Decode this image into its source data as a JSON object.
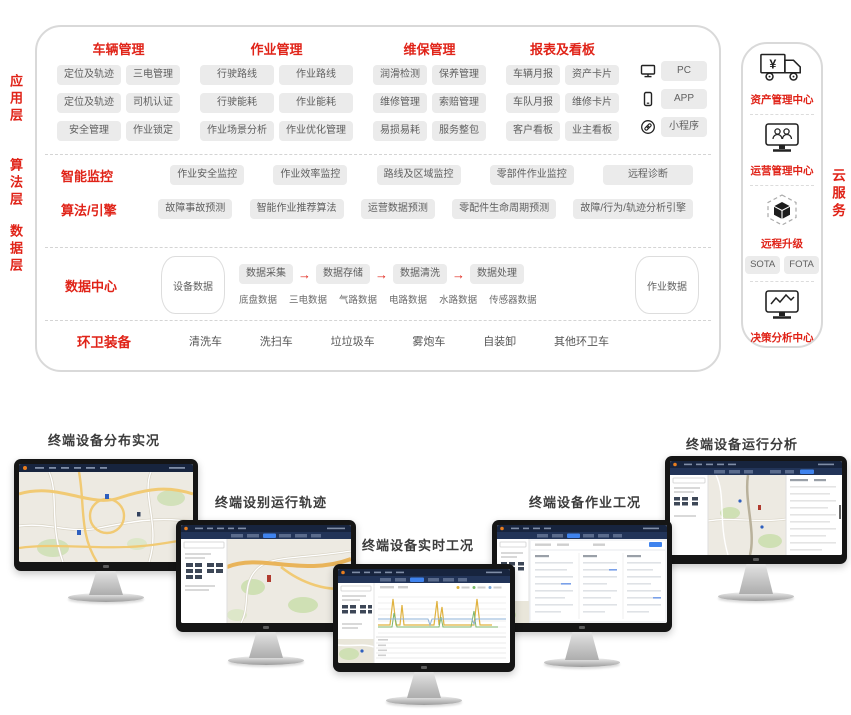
{
  "colors": {
    "accent_red": "#e02318",
    "pill_bg": "#ebebeb",
    "pill_text": "#5f5f5f",
    "screen_topbar": "#17243e",
    "screen_navbar": "#223458",
    "tab_blue": "#3f83ee"
  },
  "architecture": {
    "layer_labels": [
      "应用层",
      "算法层",
      "数据层"
    ],
    "app": {
      "groups": [
        {
          "title": "车辆管理",
          "pills": [
            "定位及轨迹",
            "三电管理",
            "定位及轨迹",
            "司机认证",
            "安全管理",
            "作业锁定"
          ]
        },
        {
          "title": "作业管理",
          "pills": [
            "行驶路线",
            "作业路线",
            "行驶能耗",
            "作业能耗",
            "作业场景分析",
            "作业优化管理"
          ]
        },
        {
          "title": "维保管理",
          "pills": [
            "润滑检测",
            "保养管理",
            "维修管理",
            "索赔管理",
            "易损易耗",
            "服务整包"
          ]
        },
        {
          "title": "报表及看板",
          "pills": [
            "车辆月报",
            "资产卡片",
            "车队月报",
            "维修卡片",
            "客户看板",
            "业主看板"
          ]
        }
      ],
      "channels": [
        {
          "icon": "pc-icon",
          "label": "PC"
        },
        {
          "icon": "phone-icon",
          "label": "APP"
        },
        {
          "icon": "miniprogram-icon",
          "label": "小程序"
        }
      ]
    },
    "algo": {
      "rows": [
        {
          "title": "智能监控",
          "pills": [
            "作业安全监控",
            "作业效率监控",
            "路线及区域监控",
            "零部件作业监控",
            "远程诊断"
          ]
        },
        {
          "title": "算法/引擎",
          "pills": [
            "故障事故预测",
            "智能作业推荐算法",
            "运营数据预测",
            "零配件生命周期预测",
            "故障/行为/轨迹分析引擎"
          ]
        }
      ]
    },
    "data": {
      "title": "数据中心",
      "device_db": "设备数据",
      "work_db": "作业数据",
      "arrow": "→",
      "flow": [
        "数据采集",
        "数据存储",
        "数据清洗",
        "数据处理"
      ],
      "sources": [
        "底盘数据",
        "三电数据",
        "气路数据",
        "电路数据",
        "水路数据",
        "传感器数据"
      ]
    },
    "equipment": {
      "title": "环卫装备",
      "items": [
        "清洗车",
        "洗扫车",
        "垃垃圾车",
        "雾炮车",
        "自装卸",
        "其他环卫车"
      ]
    }
  },
  "cloud": {
    "label": "云服务",
    "yen_glyph": "¥",
    "sections": [
      {
        "icon": "truck-icon",
        "title": "资产管理中心"
      },
      {
        "icon": "operations-monitor-icon",
        "title": "运营管理中心"
      },
      {
        "icon": "ota-cube-icon",
        "title": "远程升级",
        "pills": [
          "SOTA",
          "FOTA"
        ]
      },
      {
        "icon": "analytics-monitor-icon",
        "title": "决策分析中心"
      }
    ]
  },
  "monitors": [
    {
      "label": "终端设备分布实况"
    },
    {
      "label": "终端设别运行轨迹"
    },
    {
      "label": "终端设备实时工况"
    },
    {
      "label": "终端设备作业工况"
    },
    {
      "label": "终端设备运行分析"
    }
  ]
}
